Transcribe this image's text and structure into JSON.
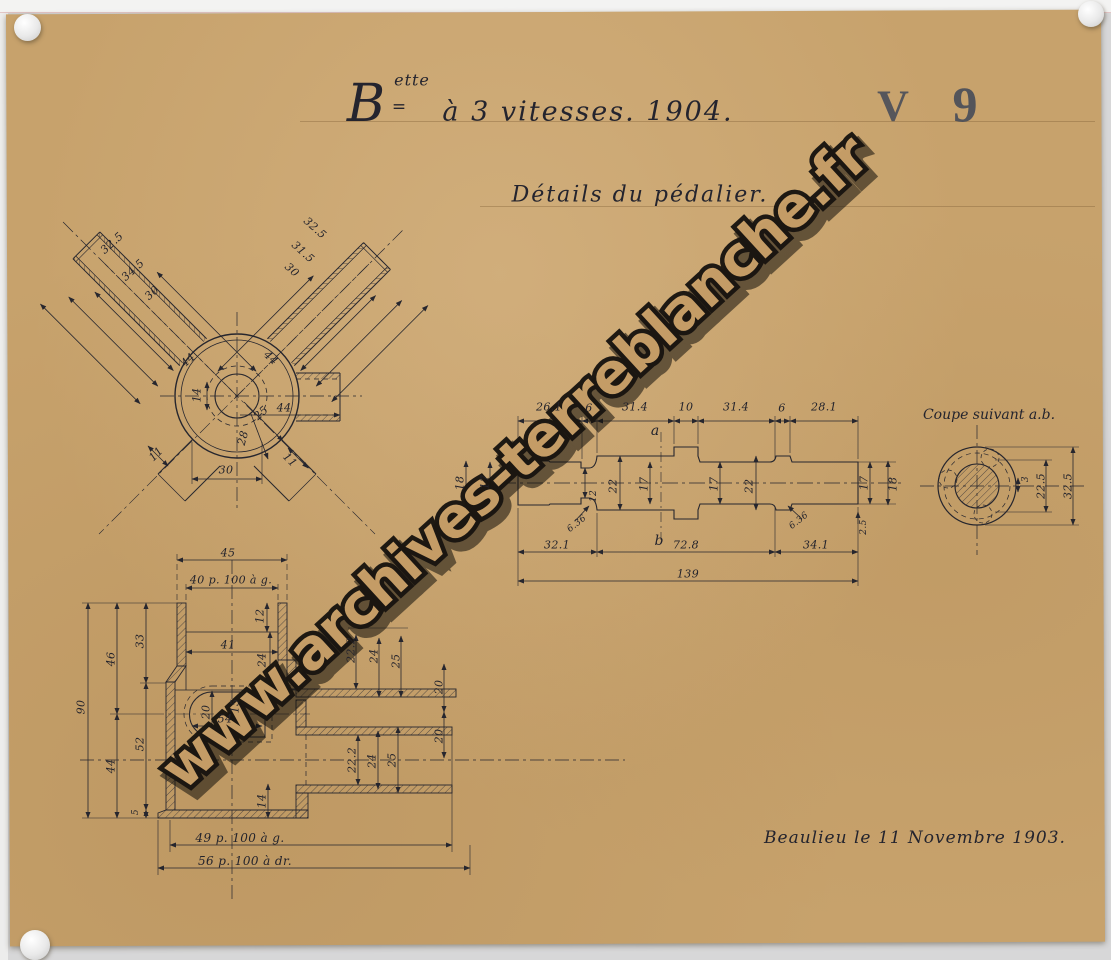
{
  "scan": {
    "paper_color": "#c7a26c",
    "background_color": "#d7d7d8",
    "ink_color": "#23232c",
    "stamp_color": "#474c59"
  },
  "header": {
    "brand_initial": "B",
    "brand_superscript": "ette",
    "brand_equals": "=",
    "title": "à 3 vitesses. 1904.",
    "code_letter": "V",
    "code_digit": "9",
    "subtitle": "Détails du pédalier."
  },
  "watermark": {
    "text": "www.archives-terreblanche.fr"
  },
  "signature": {
    "text": "Beaulieu le 11 Novembre 1903."
  },
  "front_view": {
    "left_arm": [
      "32.5",
      "34.5",
      "30"
    ],
    "right_arm": [
      "32.5",
      "31.5",
      "30"
    ],
    "axis_left": "44",
    "axis_right": "44",
    "bore": "14",
    "radial_small": "25",
    "radial_large": "28",
    "tube_length": "44",
    "bottom_width": "30",
    "wall_left": "11",
    "wall_right": "11"
  },
  "axle_view": {
    "top_dims": [
      "26.1",
      "6",
      "31.4",
      "10",
      "31.4",
      "6",
      "28.1"
    ],
    "bottom_dims": [
      "32.1",
      "72.8",
      "34.1"
    ],
    "total": "139",
    "diameters": [
      "18",
      "17",
      "12",
      "22",
      "17",
      "17",
      "22",
      "17",
      "18"
    ],
    "fillets": [
      "6.36",
      "6.36"
    ],
    "chamfer": "2.5",
    "section_marks": [
      "a",
      "b"
    ]
  },
  "section_view": {
    "title": "Coupe suivant a.b.",
    "dims": [
      "22.5",
      "32.5",
      "3"
    ]
  },
  "cut_view": {
    "top_dims": [
      "45",
      "40 p. 100 à g."
    ],
    "left_dims": [
      "90",
      "46",
      "44",
      "33",
      "52",
      "5"
    ],
    "inner_dims": [
      "12",
      "41",
      "24",
      "54",
      "20",
      "15",
      "14"
    ],
    "upper_right_dims": [
      "22.2",
      "24",
      "25"
    ],
    "axis_dims": [
      "20",
      "20"
    ],
    "lower_right_dims": [
      "22.2",
      "24",
      "25"
    ],
    "bottom_notes": [
      "49 p. 100 à g.",
      "56 p. 100 à dr."
    ]
  }
}
